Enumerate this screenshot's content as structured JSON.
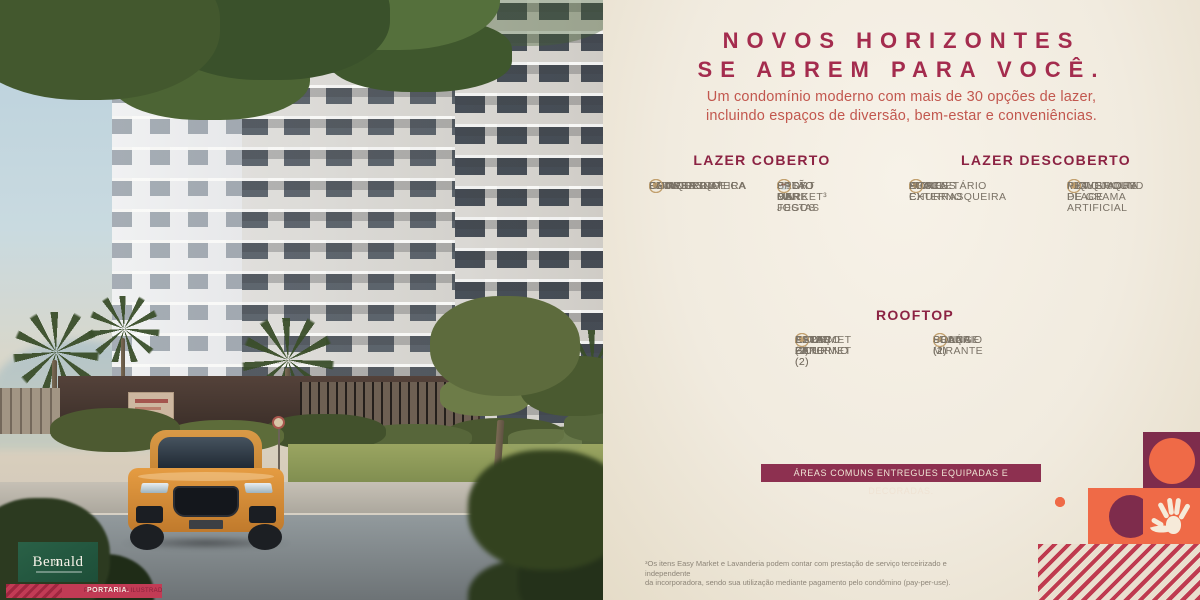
{
  "brand": {
    "name": "Bernald",
    "logo_glyph": "⌂"
  },
  "photo": {
    "caption_prefix": "PERSPECTIVA ILUSTRADA DA",
    "caption_highlight": "PORTARIA."
  },
  "header": {
    "title_line1": "NOVOS HORIZONTES",
    "title_line2": "SE ABREM PARA VOCÊ.",
    "subtitle_line1": "Um condomínio moderno com mais de 30 opções de lazer,",
    "subtitle_line2": "incluindo espaços de diversão, bem-estar e conveniências."
  },
  "sections": [
    {
      "title": "LAZER COBERTO",
      "columns": [
        {
          "items": [
            {
              "label": "BRINQUEDOTECA",
              "icon": "toy-icon",
              "glyph": "♟"
            },
            {
              "label": "CHURRASQUEIRA",
              "icon": "grill-tools-icon",
              "glyph": "⚒"
            },
            {
              "label": "COWORKING",
              "icon": "workstation-icon",
              "glyph": "✎"
            },
            {
              "label": "DELIVERY",
              "icon": "package-icon",
              "glyph": "✉"
            },
            {
              "label": "FITNESS",
              "icon": "dumbbell-icon",
              "glyph": "∞"
            },
            {
              "label": "LAVANDERIA³",
              "icon": "washer-icon",
              "glyph": "⊚"
            }
          ]
        },
        {
          "items": [
            {
              "label": "EASY MARKET³",
              "icon": "basket-icon",
              "glyph": "⊞"
            },
            {
              "label": "PET CARE",
              "icon": "paw-icon",
              "glyph": "❋"
            },
            {
              "label": "SALÃO DE FESTAS",
              "icon": "party-icon",
              "glyph": "✦"
            },
            {
              "label": "SALÃO DE JOGOS",
              "icon": "dice-icon",
              "glyph": "⚄"
            },
            {
              "label": "SPORT BAR",
              "icon": "drink-icon",
              "glyph": "☕"
            }
          ]
        }
      ]
    },
    {
      "title": "LAZER DESCOBERTO",
      "columns": [
        {
          "items": [
            {
              "label": "APOIO CHURRASQUEIRA",
              "icon": "grill-tools-icon",
              "glyph": "⚒"
            },
            {
              "label": "BICICLETÁRIO",
              "icon": "bicycle-icon",
              "glyph": "⚙"
            },
            {
              "label": "FITNESS EXTERNO",
              "icon": "dumbbell-icon",
              "glyph": "∞"
            },
            {
              "label": "HORTA",
              "icon": "plant-icon",
              "glyph": "❀"
            },
            {
              "label": "LUAU",
              "icon": "bonfire-icon",
              "glyph": "♨"
            }
          ]
        },
        {
          "items": [
            {
              "label": "MINIQUADRA DE GRAMA ARTIFICIAL",
              "icon": "sports-court-icon",
              "glyph": "▦"
            },
            {
              "label": "PET PLACE",
              "icon": "paw-icon",
              "glyph": "❃"
            },
            {
              "label": "PLAYGROUND",
              "icon": "slide-icon",
              "glyph": "▲"
            },
            {
              "label": "PIQUENIQUE",
              "icon": "picnic-icon",
              "glyph": "☂"
            }
          ]
        }
      ]
    },
    {
      "title": "ROOFTOP",
      "columns": [
        {
          "items": [
            {
              "label": "GOURMET (2)",
              "icon": "grill-tools-icon",
              "glyph": "⚒"
            },
            {
              "label": "APOIO GOURMET (2)",
              "icon": "grill-tools-icon",
              "glyph": "⚒"
            },
            {
              "label": "BATE-PAPO",
              "icon": "chat-icon",
              "glyph": "❝"
            },
            {
              "label": "ESPAÇO ZEN",
              "icon": "zen-icon",
              "glyph": "☯"
            },
            {
              "label": "ESTAR EXTERNO (2)",
              "icon": "outdoor-lounge-icon",
              "glyph": "☼"
            }
          ]
        },
        {
          "items": [
            {
              "label": "LOUNGE (2)",
              "icon": "lounge-icon",
              "glyph": "♬"
            },
            {
              "label": "LUAU (2)",
              "icon": "bonfire-icon",
              "glyph": "♨"
            },
            {
              "label": "PRAÇA MIRANTE",
              "icon": "viewpoint-icon",
              "glyph": "⊙"
            },
            {
              "label": "SOLÁRIO",
              "icon": "sun-icon",
              "glyph": "☀"
            }
          ]
        }
      ]
    }
  ],
  "banner": {
    "label": "ÁREAS COMUNS ENTREGUES EQUIPADAS E DECORADAS."
  },
  "footnote": {
    "line1": "³Os itens Easy Market e Lavanderia podem contar com prestação de serviço terceirizado e independente",
    "line2": "da incorporadora, sendo sua utilização mediante pagamento pelo condômino (pay-per-use)."
  },
  "colors": {
    "title_maroon": "#a42c4e",
    "subtitle_brick": "#c2574e",
    "section_maroon": "#8c2343",
    "item_gray": "#7a7266",
    "icon_gold": "#c2a06e",
    "banner_bg": "#8d3050",
    "accent_orange": "#ef6a47",
    "accent_deep_maroon": "#7e2c4c",
    "stripe_red": "#bf3a4f",
    "logo_green": "#1d4e38",
    "caption_red": "#c23b55",
    "panel_cream": "#f1ebdf"
  }
}
